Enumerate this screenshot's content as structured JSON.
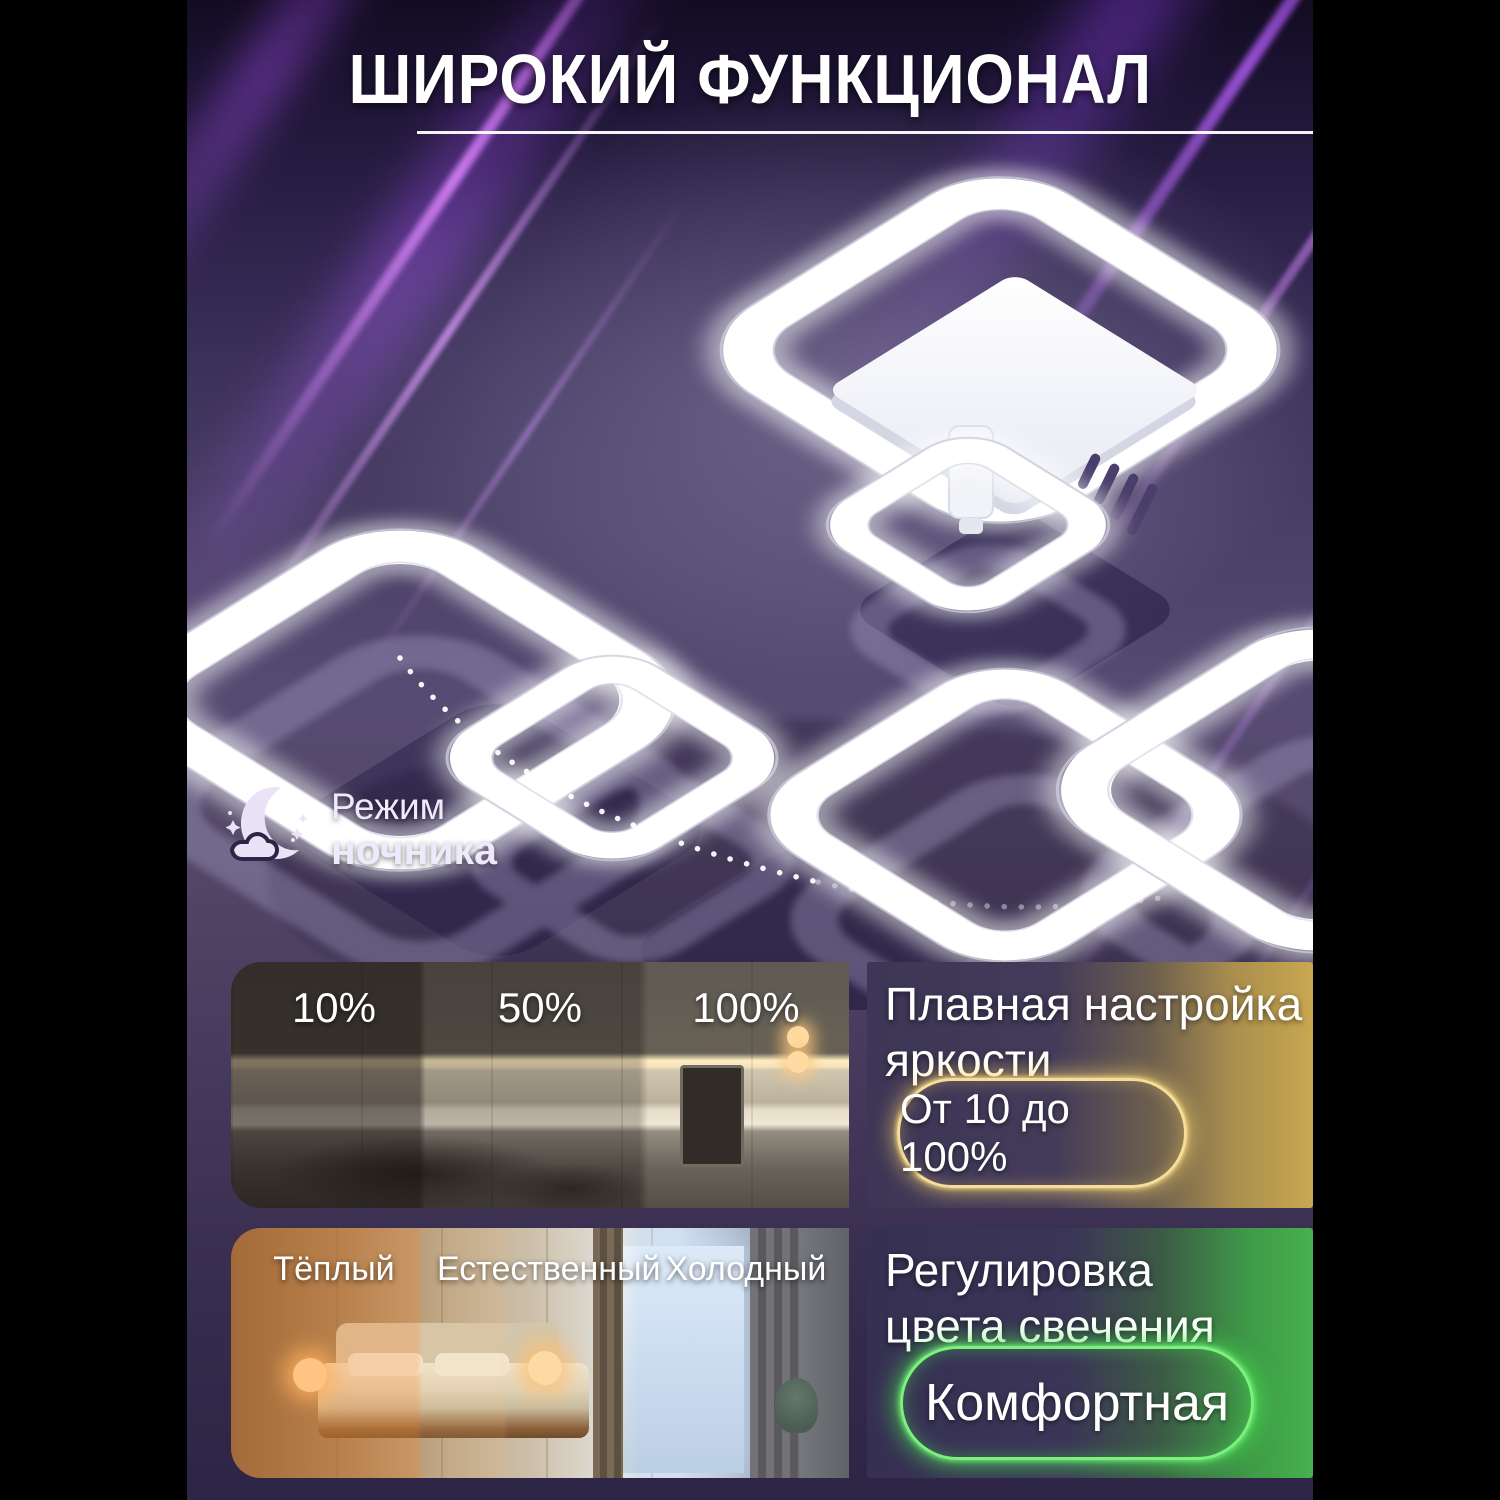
{
  "header": {
    "title": "ШИРОКИЙ ФУНКЦИОНАЛ"
  },
  "night_mode": {
    "icon": "moon-cloud-stars-icon",
    "label_line1": "Режим",
    "label_line2": "ночника"
  },
  "features": [
    {
      "id": "brightness",
      "photo_labels": [
        "10%",
        "50%",
        "100%"
      ],
      "title_line1": "Плавная настройка",
      "title_line2": "яркости",
      "badge": "От 10 до 100%",
      "accent_color": "#d9b45e"
    },
    {
      "id": "color-temperature",
      "photo_labels": [
        "Тёплый",
        "Естественный",
        "Холодный"
      ],
      "title_line1": "Регулировка",
      "title_line2": "цвета свечения",
      "badge": "Комфортная",
      "accent_color": "#4fc24f"
    }
  ],
  "colors": {
    "canvas": "#000000",
    "background_purple": "#4a3f63",
    "accent_gold": "#d9b45e",
    "accent_green": "#4fc24f",
    "text": "#ffffff"
  }
}
